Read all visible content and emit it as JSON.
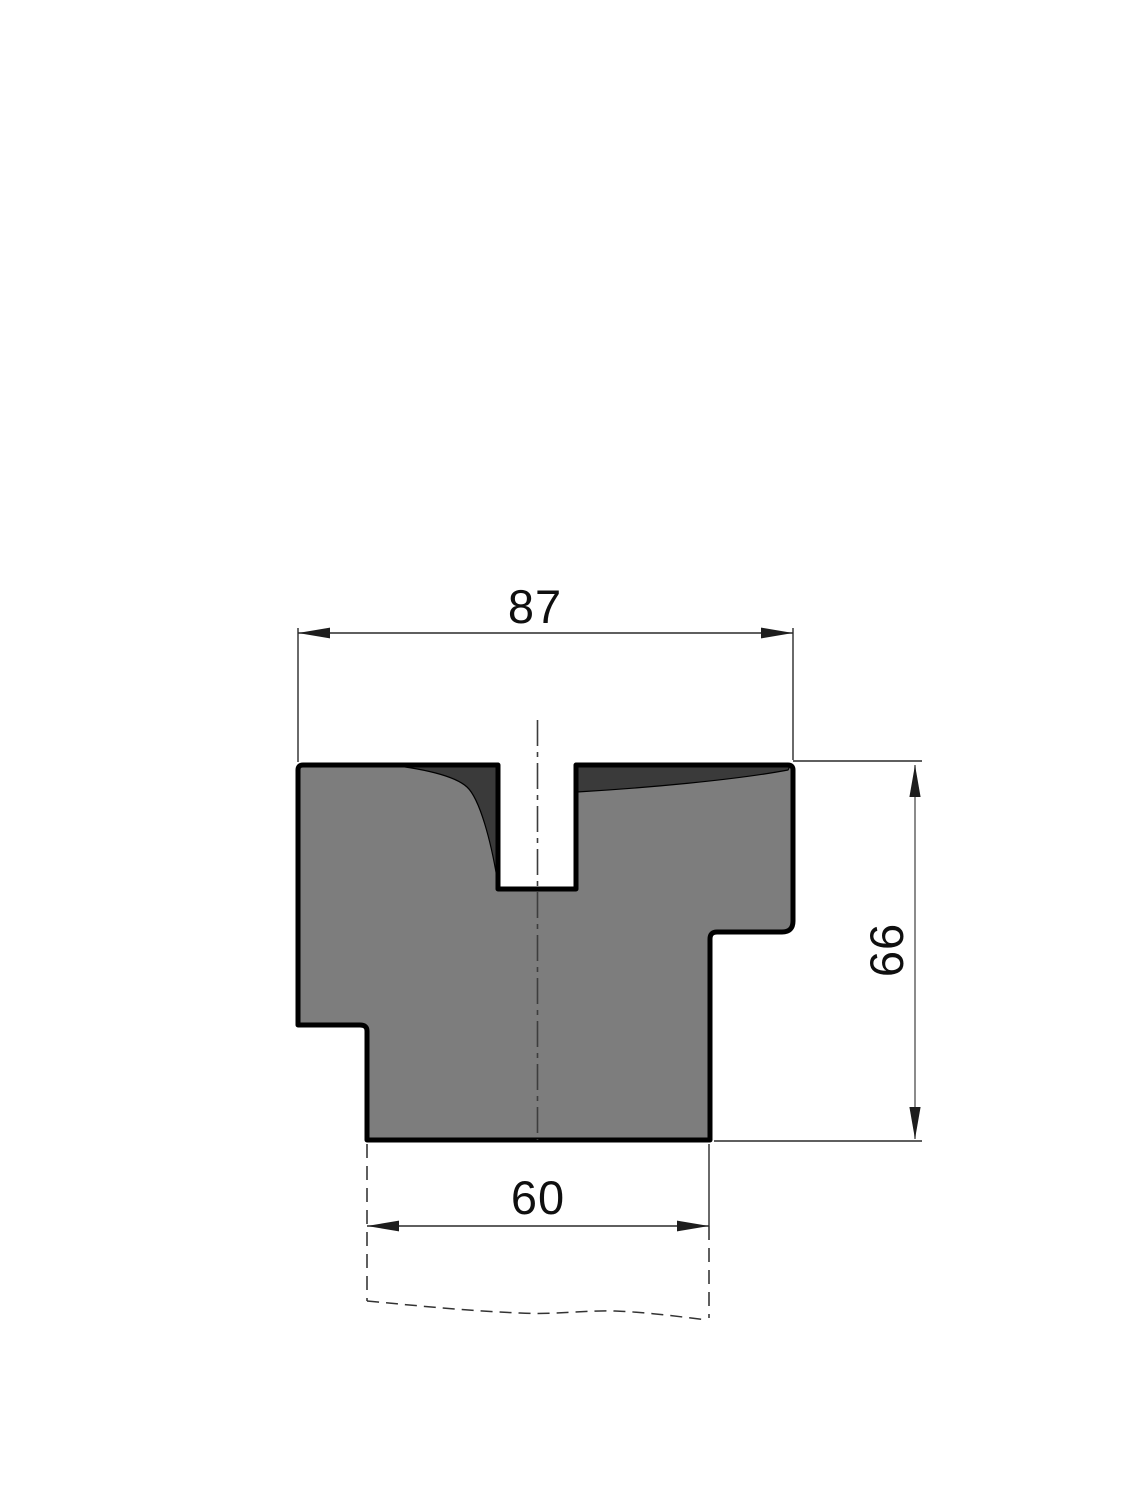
{
  "drawing": {
    "kind": "press-brake-die-cross-section",
    "dimensions": {
      "top_width": "87",
      "right_height": "66",
      "bottom_width": "60"
    },
    "colors": {
      "background": "#ffffff",
      "part_fill": "#7d7d7d",
      "shaded_face": "#3a3a3a",
      "outline": "#000000",
      "dim_lines": "#2a2a2a"
    }
  }
}
